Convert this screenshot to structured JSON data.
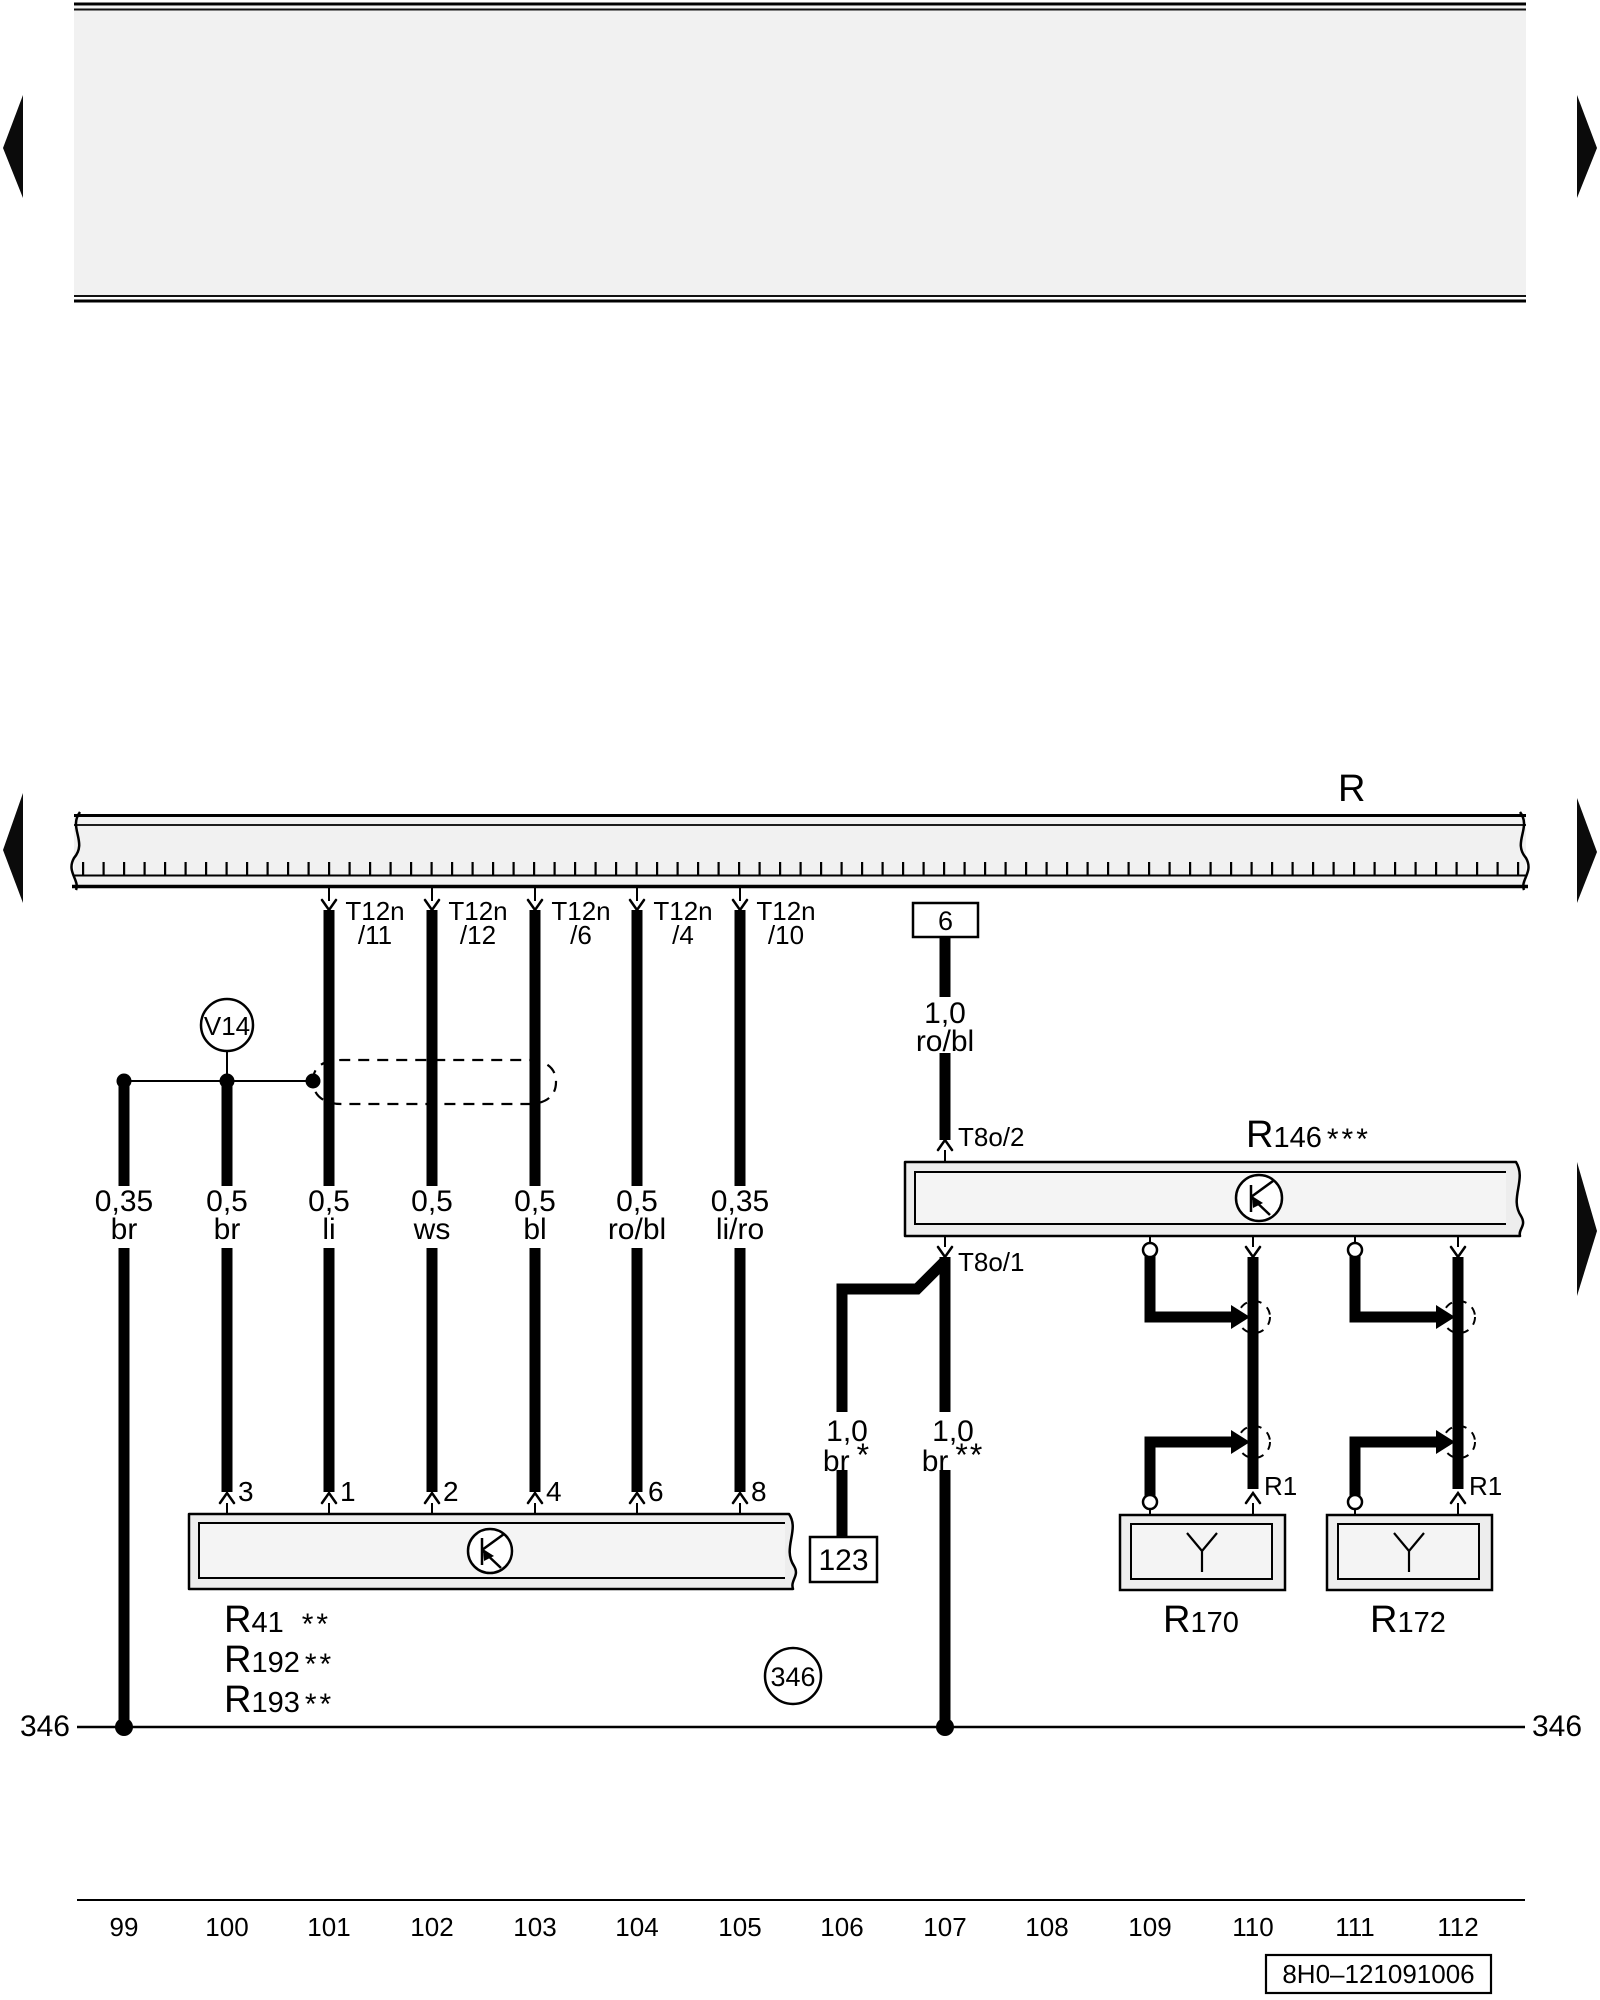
{
  "colors": {
    "ink": "#000000",
    "header_fill": "#f1f1f1",
    "box_fill": "#ededed",
    "box_inner_fill": "#f4f4f4"
  },
  "bus": {
    "label": "R"
  },
  "tracks": [
    {
      "number": "99",
      "gauge": "0,35",
      "color": "br"
    },
    {
      "number": "100",
      "gauge": "0,5",
      "color": "br",
      "pin": "3"
    },
    {
      "number": "101",
      "top": "T12n",
      "top_sub": "/11",
      "gauge": "0,5",
      "color": "li",
      "pin": "1"
    },
    {
      "number": "102",
      "top": "T12n",
      "top_sub": "/12",
      "gauge": "0,5",
      "color": "ws",
      "pin": "2"
    },
    {
      "number": "103",
      "top": "T12n",
      "top_sub": "/6",
      "gauge": "0,5",
      "color": "bl",
      "pin": "4"
    },
    {
      "number": "104",
      "top": "T12n",
      "top_sub": "/4",
      "gauge": "0,5",
      "color": "ro/bl",
      "pin": "6"
    },
    {
      "number": "105",
      "top": "T12n",
      "top_sub": "/10",
      "gauge": "0,35",
      "color": "li/ro",
      "pin": "8"
    },
    {
      "number": "106"
    },
    {
      "number": "107"
    },
    {
      "number": "108"
    },
    {
      "number": "109"
    },
    {
      "number": "110"
    },
    {
      "number": "111"
    },
    {
      "number": "112"
    }
  ],
  "v14": {
    "label": "V14"
  },
  "connector6": {
    "label": "6",
    "gauge": "1,0",
    "color": "ro/bl"
  },
  "r146": {
    "prefix": "R",
    "number": "146",
    "stars": "***",
    "pin_top": "T8o/2",
    "pin_bottom": "T8o/1"
  },
  "wire_br_star": {
    "gauge": "1,0",
    "color": "br",
    "stars": "*"
  },
  "wire_br_2star": {
    "gauge": "1,0",
    "color": "br",
    "stars": "**"
  },
  "box123": {
    "label": "123"
  },
  "ground_circle": {
    "label": "346"
  },
  "ground": {
    "left_label": "346",
    "right_label": "346"
  },
  "heater_left": {
    "prefix": "R",
    "number": "170",
    "terminal": "R1"
  },
  "heater_right": {
    "prefix": "R",
    "number": "172",
    "terminal": "R1"
  },
  "component_labels": [
    {
      "prefix": "R",
      "number": "41",
      "stars": "**"
    },
    {
      "prefix": "R",
      "number": "192",
      "stars": "**"
    },
    {
      "prefix": "R",
      "number": "193",
      "stars": "**"
    }
  ],
  "part_number": {
    "label": "8H0–121091006"
  }
}
